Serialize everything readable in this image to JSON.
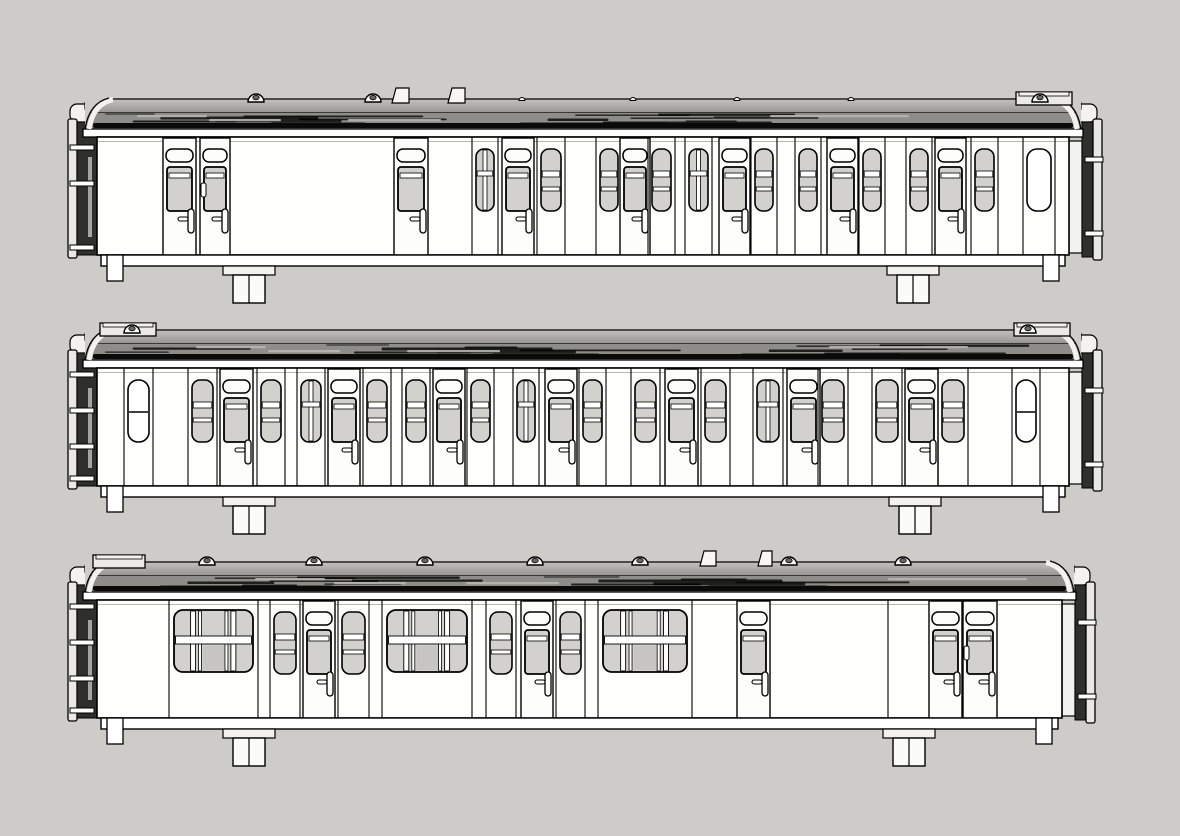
{
  "scene": {
    "background": "#cdccc8",
    "body_fill": "#fefefc",
    "door_fill": "#fdfdfb",
    "glass_fill": "#d2d1cd",
    "glass_dark": "#c6c5c1",
    "line_color": "#000000",
    "roof_top_light": "#c3c2be",
    "roof_top_dark": "#949390",
    "roof_mid": "#8e8d89",
    "roof_black": "#0a0a0a",
    "gutter_fill": "#ffffff",
    "end_dark": "#2f2f2d",
    "end_plate": "#e9e8e4",
    "fitting_fill": "#f3f2ee"
  },
  "carriages": [
    {
      "id": "carriage-1",
      "kind": "brake-compartment-coach",
      "offset_y": 95,
      "body": {
        "x": 97,
        "width": 972
      },
      "left_end": {
        "tabs_y": [
          50,
          86,
          150
        ]
      },
      "right_end": {
        "tabs_y": [
          62,
          136
        ]
      },
      "roof": {
        "domes": [
          256,
          373,
          1040
        ],
        "bumps": [
          522,
          633,
          737,
          851
        ],
        "tabs": [
          {
            "x": 392,
            "w": 17
          },
          {
            "x": 448,
            "w": 17
          }
        ],
        "end_boxes": [
          {
            "x": 1016,
            "w": 56
          }
        ]
      },
      "underframe": {
        "boxes": [
          233,
          897
        ]
      },
      "extra_seams": [],
      "elements": [
        {
          "type": "door",
          "x": 163,
          "w": 33
        },
        {
          "type": "door",
          "x": 200,
          "w": 30,
          "variant": "clip"
        },
        {
          "type": "door",
          "x": 394,
          "w": 34
        },
        {
          "type": "win2v",
          "x": 476,
          "w": 18
        },
        {
          "type": "door",
          "x": 502,
          "w": 32
        },
        {
          "type": "win2h",
          "x": 541,
          "w": 20
        },
        {
          "type": "win2h",
          "x": 600,
          "w": 18
        },
        {
          "type": "door",
          "x": 620,
          "w": 30
        },
        {
          "type": "win2h",
          "x": 652,
          "w": 19
        },
        {
          "type": "win2v",
          "x": 689,
          "w": 19
        },
        {
          "type": "door",
          "x": 719,
          "w": 31
        },
        {
          "type": "win2h",
          "x": 755,
          "w": 18
        },
        {
          "type": "win2h",
          "x": 799,
          "w": 18
        },
        {
          "type": "door",
          "x": 827,
          "w": 31
        },
        {
          "type": "win2h",
          "x": 863,
          "w": 18
        },
        {
          "type": "win2h",
          "x": 910,
          "w": 18
        },
        {
          "type": "door",
          "x": 935,
          "w": 31
        },
        {
          "type": "win2h",
          "x": 975,
          "w": 19
        },
        {
          "type": "winplain",
          "x": 1027,
          "w": 24,
          "bar": false
        }
      ]
    },
    {
      "id": "carriage-2",
      "kind": "compartment-coach",
      "offset_y": 326,
      "body": {
        "x": 97,
        "width": 972
      },
      "left_end": {
        "tabs_y": [
          46,
          82,
          118,
          150
        ]
      },
      "right_end": {
        "tabs_y": [
          62,
          136
        ]
      },
      "roof": {
        "domes": [
          132,
          1028
        ],
        "bumps": [],
        "tabs": [],
        "end_boxes": [
          {
            "x": 100,
            "w": 56
          },
          {
            "x": 1014,
            "w": 56
          }
        ]
      },
      "underframe": {
        "boxes": [
          233,
          899
        ]
      },
      "extra_seams": [],
      "elements": [
        {
          "type": "winplain",
          "x": 128,
          "w": 21,
          "bar": true
        },
        {
          "type": "win2h",
          "x": 192,
          "w": 21
        },
        {
          "type": "door",
          "x": 220,
          "w": 33
        },
        {
          "type": "win2h",
          "x": 261,
          "w": 20
        },
        {
          "type": "win2v",
          "x": 301,
          "w": 20
        },
        {
          "type": "door",
          "x": 328,
          "w": 32
        },
        {
          "type": "win2h",
          "x": 367,
          "w": 20
        },
        {
          "type": "win2h",
          "x": 406,
          "w": 20
        },
        {
          "type": "door",
          "x": 433,
          "w": 32
        },
        {
          "type": "win2h",
          "x": 471,
          "w": 19
        },
        {
          "type": "win2v",
          "x": 517,
          "w": 18
        },
        {
          "type": "door",
          "x": 545,
          "w": 32
        },
        {
          "type": "win2h",
          "x": 583,
          "w": 19
        },
        {
          "type": "win2h",
          "x": 635,
          "w": 21
        },
        {
          "type": "door",
          "x": 665,
          "w": 33
        },
        {
          "type": "win2h",
          "x": 705,
          "w": 21
        },
        {
          "type": "win2v",
          "x": 757,
          "w": 22
        },
        {
          "type": "door",
          "x": 787,
          "w": 33
        },
        {
          "type": "win2h",
          "x": 822,
          "w": 22
        },
        {
          "type": "win2h",
          "x": 876,
          "w": 22
        },
        {
          "type": "door",
          "x": 905,
          "w": 33
        },
        {
          "type": "win2h",
          "x": 942,
          "w": 22
        },
        {
          "type": "winplain",
          "x": 1016,
          "w": 20,
          "bar": true
        }
      ]
    },
    {
      "id": "carriage-3",
      "kind": "saloon-brake-coach",
      "offset_y": 558,
      "body": {
        "x": 97,
        "width": 965
      },
      "left_end": {
        "tabs_y": [
          46,
          82,
          118,
          150
        ]
      },
      "right_end": {
        "tabs_y": [
          62,
          136
        ]
      },
      "roof": {
        "domes": [
          207,
          314,
          425,
          535,
          640,
          789,
          903
        ],
        "bumps": [],
        "tabs": [
          {
            "x": 700,
            "w": 16
          },
          {
            "x": 758,
            "w": 14
          }
        ],
        "end_boxes": [
          {
            "x": 93,
            "w": 52
          }
        ]
      },
      "underframe": {
        "boxes": [
          233,
          893
        ]
      },
      "extra_seams": [
        888
      ],
      "elements": [
        {
          "type": "bigwin",
          "x": 174,
          "w": 79
        },
        {
          "type": "win2h",
          "x": 274,
          "w": 22
        },
        {
          "type": "door",
          "x": 303,
          "w": 32
        },
        {
          "type": "win2h",
          "x": 342,
          "w": 23
        },
        {
          "type": "bigwin",
          "x": 387,
          "w": 80
        },
        {
          "type": "win2h",
          "x": 490,
          "w": 22
        },
        {
          "type": "door",
          "x": 521,
          "w": 32
        },
        {
          "type": "win2h",
          "x": 560,
          "w": 21
        },
        {
          "type": "bigwin",
          "x": 603,
          "w": 84
        },
        {
          "type": "door",
          "x": 737,
          "w": 33
        },
        {
          "type": "door",
          "x": 929,
          "w": 33
        },
        {
          "type": "door",
          "x": 963,
          "w": 34,
          "variant": "clip"
        }
      ]
    }
  ]
}
